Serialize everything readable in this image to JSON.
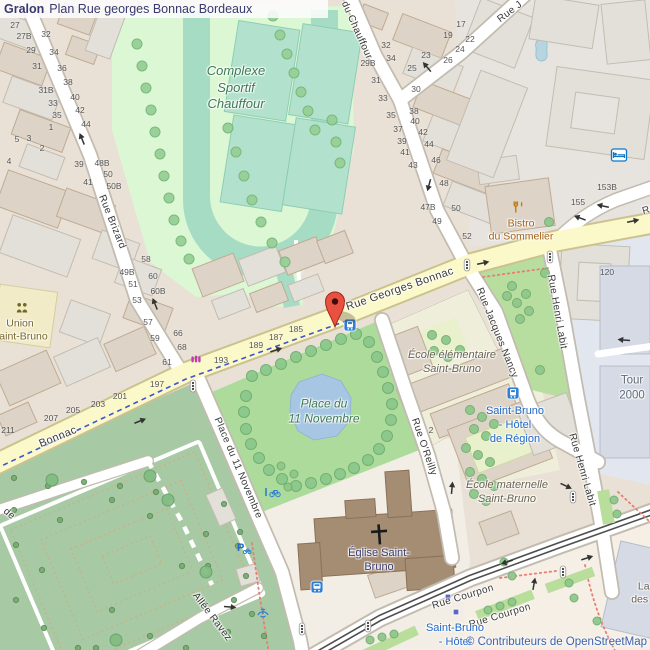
{
  "title": {
    "brand": "Gralon",
    "text": "Plan Rue georges Bonnac Bordeaux"
  },
  "attribution": "© Contributeurs de OpenStreetMap",
  "colors": {
    "background": "#eae1d6",
    "main_road": "#fbf8c9",
    "water": "#a6c6e3",
    "park": "#addb9c",
    "cemetery": "#a7c9a4",
    "sports_ground": "#dbf7d4",
    "track": "#a6dcc4",
    "marker_red": "#e9503f",
    "transit_blue": "#2268c8",
    "amenity_amber": "#c07700",
    "label_green": "#3e7a55",
    "attribution_blue": "#3c62b0"
  },
  "icons": {
    "map-marker": "red teardrop pin",
    "tram-stop": "blue square with tram",
    "bus-stop": "blue square with bus",
    "hotel": "blue bed",
    "restaurant": "amber fork and knife",
    "community-centre": "olive two persons",
    "shop": "magenta shop glyph",
    "parking": "blue P",
    "bicycle-parking": "blue bicycle",
    "fountain": "blue fountain",
    "traffic-light": "white pill with three dots",
    "one-way-arrow": "black arrow",
    "tram-stop-marker": "small indigo square"
  },
  "map": {
    "street_labels": [
      {
        "text": "Rue Brizard",
        "x": 112,
        "y": 222,
        "rot": 68
      },
      {
        "text": "Rue du Chauffour",
        "x": 352,
        "y": 20,
        "rot": 66
      },
      {
        "text": "Rue J",
        "x": 510,
        "y": 12,
        "rot": -37
      },
      {
        "text": "Rue Georges Bonnac",
        "x": 400,
        "y": 289,
        "rot": -19,
        "size": 11
      },
      {
        "text": "Bonnac",
        "x": 58,
        "y": 437,
        "rot": -22,
        "size": 11
      },
      {
        "text": "Rue Jacques Nancy",
        "x": 497,
        "y": 333,
        "rot": 68
      },
      {
        "text": "Rue Henri Labit",
        "x": 557,
        "y": 312,
        "rot": 80
      },
      {
        "text": "Rue Henri Labit",
        "x": 582,
        "y": 470,
        "rot": 74
      },
      {
        "text": "Rue O'Reilly",
        "x": 424,
        "y": 447,
        "rot": 71
      },
      {
        "text": "Place du 11 Novembre",
        "x": 238,
        "y": 468,
        "rot": 67
      },
      {
        "text": "Allée Ravez",
        "x": 212,
        "y": 617,
        "rot": 53
      },
      {
        "text": "Rue Courpon",
        "x": 463,
        "y": 597,
        "rot": -17
      },
      {
        "text": "Rue Courpon",
        "x": 500,
        "y": 616,
        "rot": -17
      },
      {
        "text": "de",
        "x": 9,
        "y": 514,
        "rot": 40
      },
      {
        "text": "Rue",
        "x": 652,
        "y": 209,
        "rot": -16
      }
    ],
    "poi_labels": [
      {
        "id": "complexe-sportif-chauffour",
        "lines": [
          "Complexe",
          "Sportif",
          "Chauffour"
        ],
        "x": 236,
        "y": 88,
        "color": "#3e7a55",
        "italic": true,
        "size": 13
      },
      {
        "id": "place-du-11-novembre-park",
        "lines": [
          "Place du",
          "11 Novembre"
        ],
        "x": 324,
        "y": 412,
        "color": "#3e7a55",
        "italic": true,
        "size": 12
      },
      {
        "id": "bistro-du-sommelier",
        "lines": [
          "Bistro",
          "du Sommelier"
        ],
        "x": 521,
        "y": 231,
        "color": "#a2611b",
        "italic": false,
        "size": 10.5
      },
      {
        "id": "union-saint-bruno",
        "lines": [
          "Union",
          "Saint-Bruno"
        ],
        "x": 20,
        "y": 331,
        "color": "#7a672c",
        "italic": false,
        "size": 10.5
      },
      {
        "id": "ecole-elementaire-saint-bruno",
        "lines": [
          "École élémentaire",
          "Saint-Bruno"
        ],
        "x": 452,
        "y": 362,
        "color": "#6a6450",
        "italic": true,
        "size": 11
      },
      {
        "id": "ecole-maternelle-saint-bruno",
        "lines": [
          "École maternelle",
          "Saint-Bruno"
        ],
        "x": 507,
        "y": 492,
        "color": "#6a6450",
        "italic": true,
        "size": 11
      },
      {
        "id": "eglise-saint-bruno",
        "lines": [
          "Église Saint-",
          "Bruno"
        ],
        "x": 379,
        "y": 560,
        "color": "#3c3c72",
        "italic": false,
        "size": 11
      },
      {
        "id": "tour-2000",
        "lines": [
          "Tour",
          "2000"
        ],
        "x": 632,
        "y": 388,
        "color": "#5f6b7a",
        "italic": false,
        "size": 11.5
      },
      {
        "id": "la-c-des-for",
        "lines": [
          "La C",
          "des For"
        ],
        "x": 649,
        "y": 594,
        "color": "#6b6152",
        "italic": false,
        "size": 10.5
      },
      {
        "id": "tram-stop-saint-bruno-hotel-de-region",
        "lines": [
          "Saint-Bruno",
          "- Hôtel",
          "de Région"
        ],
        "x": 515,
        "y": 425,
        "color": "#2268c8",
        "italic": false,
        "size": 11
      },
      {
        "id": "tram-stop-saint-bruno-hotel-de-region-2",
        "lines": [
          "Saint-Bruno",
          "- Hôtel",
          "de Région"
        ],
        "x": 455,
        "y": 642,
        "color": "#2268c8",
        "italic": false,
        "size": 11
      }
    ],
    "house_numbers": [
      [
        "27",
        15,
        25
      ],
      [
        "27B",
        24,
        36
      ],
      [
        "32",
        46,
        34
      ],
      [
        "29",
        31,
        50
      ],
      [
        "34",
        54,
        52
      ],
      [
        "31",
        37,
        66
      ],
      [
        "36",
        62,
        68
      ],
      [
        "31B",
        46,
        90
      ],
      [
        "38",
        68,
        82
      ],
      [
        "40",
        75,
        97
      ],
      [
        "33",
        53,
        103
      ],
      [
        "42",
        80,
        110
      ],
      [
        "35",
        57,
        115
      ],
      [
        "44",
        86,
        124
      ],
      [
        "1",
        51,
        127
      ],
      [
        "5",
        17,
        139
      ],
      [
        "3",
        29,
        138
      ],
      [
        "2",
        42,
        148
      ],
      [
        "4",
        9,
        161
      ],
      [
        "17",
        461,
        24
      ],
      [
        "19",
        448,
        35
      ],
      [
        "22",
        470,
        39
      ],
      [
        "24",
        460,
        49
      ],
      [
        "23",
        426,
        55
      ],
      [
        "26",
        448,
        60
      ],
      [
        "25",
        412,
        68
      ],
      [
        "32",
        386,
        45
      ],
      [
        "34",
        391,
        58
      ],
      [
        "29B",
        368,
        63
      ],
      [
        "31",
        376,
        80
      ],
      [
        "30",
        416,
        89
      ],
      [
        "33",
        383,
        98
      ],
      [
        "38",
        414,
        111
      ],
      [
        "35",
        391,
        115
      ],
      [
        "40",
        415,
        121
      ],
      [
        "37",
        398,
        129
      ],
      [
        "42",
        423,
        132
      ],
      [
        "39",
        402,
        141
      ],
      [
        "44",
        429,
        144
      ],
      [
        "41",
        405,
        152
      ],
      [
        "43",
        413,
        165
      ],
      [
        "46",
        436,
        160
      ],
      [
        "48",
        444,
        183
      ],
      [
        "47B",
        428,
        207
      ],
      [
        "50",
        456,
        208
      ],
      [
        "49",
        437,
        221
      ],
      [
        "52",
        467,
        236
      ],
      [
        "39",
        79,
        164
      ],
      [
        "48B",
        102,
        163
      ],
      [
        "50",
        108,
        174
      ],
      [
        "41",
        88,
        182
      ],
      [
        "50B",
        114,
        186
      ],
      [
        "58",
        146,
        259
      ],
      [
        "49B",
        127,
        272
      ],
      [
        "60",
        153,
        276
      ],
      [
        "51",
        133,
        284
      ],
      [
        "60B",
        158,
        291
      ],
      [
        "53",
        137,
        300
      ],
      [
        "57",
        148,
        322
      ],
      [
        "66",
        178,
        333
      ],
      [
        "59",
        155,
        338
      ],
      [
        "68",
        182,
        347
      ],
      [
        "61",
        167,
        362
      ],
      [
        "185",
        296,
        329
      ],
      [
        "187",
        276,
        337
      ],
      [
        "189",
        256,
        345
      ],
      [
        "193",
        221,
        360
      ],
      [
        "197",
        157,
        384
      ],
      [
        "201",
        120,
        396
      ],
      [
        "203",
        98,
        404
      ],
      [
        "205",
        73,
        410
      ],
      [
        "207",
        51,
        418
      ],
      [
        "211",
        8,
        430
      ],
      [
        "153B",
        607,
        187
      ],
      [
        "155",
        578,
        202
      ],
      [
        "120",
        607,
        272
      ],
      [
        "2",
        431,
        430
      ]
    ],
    "trees": [
      {
        "r": 5,
        "fill": "#97d097",
        "stroke": "#76b676",
        "pts": [
          [
            137,
            44
          ],
          [
            142,
            66
          ],
          [
            146,
            88
          ],
          [
            151,
            110
          ],
          [
            155,
            132
          ],
          [
            160,
            154
          ],
          [
            164,
            176
          ],
          [
            169,
            198
          ],
          [
            174,
            220
          ],
          [
            181,
            241
          ],
          [
            189,
            259
          ],
          [
            273,
            16
          ],
          [
            280,
            35
          ],
          [
            287,
            54
          ],
          [
            294,
            73
          ],
          [
            301,
            92
          ],
          [
            308,
            111
          ],
          [
            315,
            130
          ],
          [
            228,
            128
          ],
          [
            236,
            152
          ],
          [
            244,
            176
          ],
          [
            252,
            200
          ],
          [
            261,
            222
          ],
          [
            272,
            243
          ],
          [
            285,
            262
          ],
          [
            332,
            120
          ],
          [
            336,
            142
          ],
          [
            340,
            163
          ]
        ]
      },
      {
        "r": 5.5,
        "fill": "#8cc98c",
        "stroke": "#6fae6f",
        "pts": [
          [
            252,
            376
          ],
          [
            266,
            370
          ],
          [
            281,
            364
          ],
          [
            296,
            357
          ],
          [
            311,
            351
          ],
          [
            326,
            345
          ],
          [
            341,
            339
          ],
          [
            356,
            334
          ],
          [
            369,
            342
          ],
          [
            377,
            357
          ],
          [
            383,
            372
          ],
          [
            388,
            388
          ],
          [
            392,
            404
          ],
          [
            391,
            420
          ],
          [
            387,
            436
          ],
          [
            379,
            449
          ],
          [
            368,
            460
          ],
          [
            354,
            468
          ],
          [
            340,
            474
          ],
          [
            326,
            479
          ],
          [
            311,
            483
          ],
          [
            296,
            486
          ],
          [
            282,
            479
          ],
          [
            269,
            470
          ],
          [
            259,
            458
          ],
          [
            251,
            444
          ],
          [
            246,
            429
          ],
          [
            244,
            412
          ],
          [
            246,
            396
          ]
        ]
      },
      {
        "r": 4.5,
        "fill": "#8fc78b",
        "stroke": "#72ad6e",
        "pts": [
          [
            512,
            286
          ],
          [
            526,
            294
          ],
          [
            517,
            303
          ],
          [
            529,
            311
          ],
          [
            520,
            319
          ],
          [
            507,
            296
          ],
          [
            540,
            370
          ],
          [
            549,
            222
          ],
          [
            545,
            273
          ],
          [
            432,
            335
          ],
          [
            446,
            340
          ],
          [
            434,
            351
          ],
          [
            448,
            357
          ],
          [
            460,
            350
          ],
          [
            470,
            410
          ],
          [
            482,
            417
          ],
          [
            494,
            424
          ],
          [
            474,
            429
          ],
          [
            486,
            436
          ],
          [
            466,
            448
          ],
          [
            478,
            455
          ],
          [
            490,
            462
          ],
          [
            470,
            472
          ],
          [
            482,
            479
          ],
          [
            494,
            486
          ],
          [
            474,
            494
          ],
          [
            486,
            501
          ]
        ]
      },
      {
        "r": 4,
        "fill": "#8fc78b",
        "stroke": "#72ad6e",
        "pts": [
          [
            281,
            466
          ],
          [
            294,
            474
          ],
          [
            288,
            487
          ],
          [
            504,
            562
          ],
          [
            512,
            576
          ],
          [
            569,
            583
          ],
          [
            574,
            598
          ],
          [
            614,
            500
          ],
          [
            617,
            514
          ],
          [
            597,
            621
          ],
          [
            488,
            610
          ],
          [
            500,
            606
          ],
          [
            512,
            602
          ],
          [
            370,
            640
          ],
          [
            382,
            637
          ],
          [
            394,
            634
          ]
        ]
      },
      {
        "r": 2.6,
        "fill": "#79ab74",
        "stroke": "#5d8f58",
        "pts": [
          [
            14,
            478
          ],
          [
            48,
            486
          ],
          [
            84,
            482
          ],
          [
            120,
            486
          ],
          [
            156,
            492
          ],
          [
            14,
            510
          ],
          [
            60,
            520
          ],
          [
            16,
            545
          ],
          [
            42,
            570
          ],
          [
            16,
            600
          ],
          [
            44,
            628
          ],
          [
            78,
            648
          ],
          [
            112,
            610
          ],
          [
            150,
            636
          ],
          [
            186,
            648
          ],
          [
            204,
            604
          ],
          [
            228,
            632
          ],
          [
            234,
            600
          ],
          [
            208,
            566
          ],
          [
            238,
            546
          ],
          [
            112,
            500
          ],
          [
            150,
            516
          ],
          [
            252,
            614
          ],
          [
            264,
            636
          ],
          [
            96,
            648
          ],
          [
            224,
            504
          ],
          [
            240,
            532
          ],
          [
            182,
            566
          ],
          [
            206,
            534
          ],
          [
            246,
            576
          ]
        ]
      },
      {
        "r": 6,
        "fill": "#83bd83",
        "stroke": "#68a268",
        "pts": [
          [
            52,
            480
          ],
          [
            150,
            476
          ],
          [
            168,
            500
          ],
          [
            206,
            572
          ],
          [
            116,
            640
          ]
        ]
      }
    ],
    "arrows": [
      [
        427,
        67,
        230
      ],
      [
        429,
        185,
        105
      ],
      [
        483,
        263,
        -12
      ],
      [
        276,
        350,
        -18
      ],
      [
        140,
        421,
        -22
      ],
      [
        603,
        206,
        192
      ],
      [
        633,
        221,
        -12
      ],
      [
        452,
        488,
        -85
      ],
      [
        566,
        486,
        25
      ],
      [
        507,
        562,
        162
      ],
      [
        587,
        558,
        -18
      ],
      [
        230,
        607,
        5
      ],
      [
        534,
        584,
        -80
      ],
      [
        580,
        218,
        200
      ],
      [
        82,
        139,
        -112
      ],
      [
        155,
        304,
        -112
      ],
      [
        624,
        340,
        185
      ]
    ],
    "traffic_lights": [
      [
        467,
        265
      ],
      [
        550,
        257
      ],
      [
        193,
        386
      ],
      [
        563,
        572
      ],
      [
        368,
        626
      ],
      [
        302,
        629
      ],
      [
        573,
        497
      ]
    ],
    "stop_markers": [
      [
        448,
        597
      ],
      [
        456,
        612
      ]
    ]
  }
}
